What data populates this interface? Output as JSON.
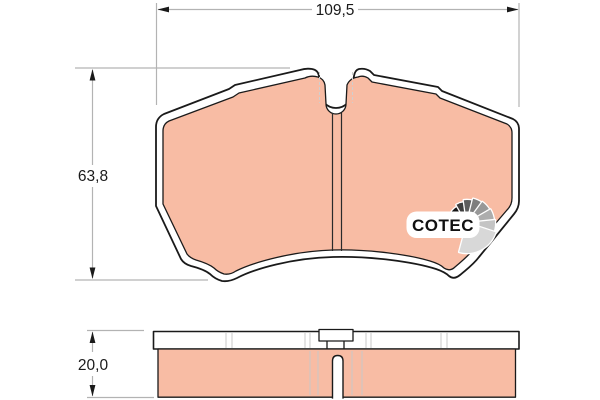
{
  "title": "Brake pad technical drawing",
  "dimensions": {
    "width": {
      "label": "109,5"
    },
    "height": {
      "label": "63,8"
    },
    "thickness": {
      "label": "20,0"
    }
  },
  "logo": {
    "text": "COTEC"
  },
  "colors": {
    "background": "#ffffff",
    "friction_pad": "#f8bca4",
    "outline": "#1a1a1a",
    "dimension_line": "#b3b3b3",
    "hidden_line": "#c9c9c9",
    "logo_text": "#111111",
    "logo_fan_dark": "#141414",
    "logo_fan_light": "#d8d8d8"
  }
}
